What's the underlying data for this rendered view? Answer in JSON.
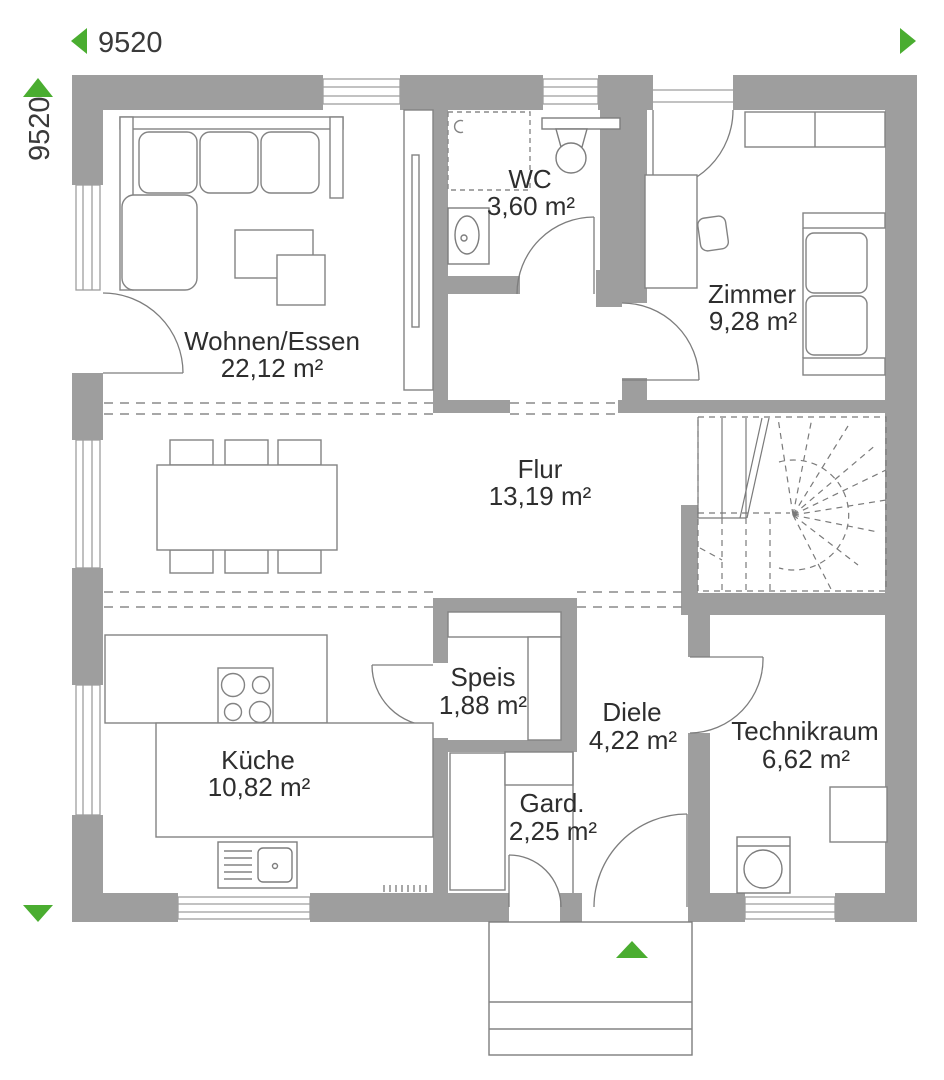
{
  "plan": {
    "type": "floor-plan",
    "accent_color": "#4aad30",
    "wall_color": "#9e9e9e"
  },
  "dimensions": {
    "width_label": "9520",
    "height_label": "9520"
  },
  "rooms": [
    {
      "name": "Wohnen/Essen",
      "area": "22,12 m²"
    },
    {
      "name": "WC",
      "area": "3,60 m²"
    },
    {
      "name": "Zimmer",
      "area": "9,28 m²"
    },
    {
      "name": "Flur",
      "area": "13,19 m²"
    },
    {
      "name": "Speis",
      "area": "1,88 m²"
    },
    {
      "name": "Diele",
      "area": "4,22 m²"
    },
    {
      "name": "Technikraum",
      "area": "6,62 m²"
    },
    {
      "name": "Küche",
      "area": "10,82 m²"
    },
    {
      "name": "Gard.",
      "area": "2,25 m²"
    }
  ]
}
